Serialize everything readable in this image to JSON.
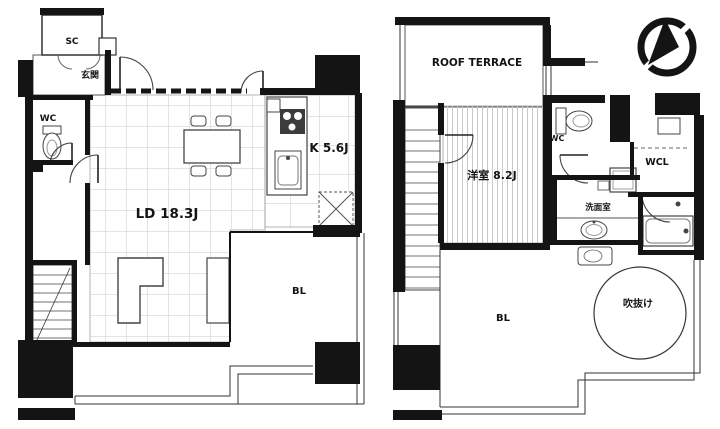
{
  "document": {
    "kind": "apartment-floor-plan",
    "floors": [
      {
        "name": "lower-floor",
        "rooms": [
          "玄関",
          "SC",
          "WC",
          "LD 18.3J",
          "K 5.6J",
          "BL"
        ]
      },
      {
        "name": "upper-floor",
        "rooms": [
          "ROOF TERRACE",
          "洋室 8.2J",
          "WC",
          "WCL",
          "洗面室",
          "吹抜け",
          "BL"
        ]
      }
    ]
  },
  "labels": {
    "sc": "SC",
    "genkan": "玄関",
    "wc_lower": "WC",
    "ld": "LD 18.3J",
    "kitchen": "K 5.6J",
    "bl_lower": "BL",
    "roof_terrace": "ROOF TERRACE",
    "bedroom": "洋室 8.2J",
    "wc_upper": "WC",
    "wcl": "WCL",
    "washroom": "洗面室",
    "void": "吹抜け",
    "bl_upper": "BL"
  },
  "icons": {
    "compass": "north-arrow-compass"
  },
  "colors": {
    "background": "#ffffff",
    "wall": "#141414",
    "thin_line": "#444444",
    "grid": "#c5cbd1",
    "stripe": "#c9c9c9"
  }
}
